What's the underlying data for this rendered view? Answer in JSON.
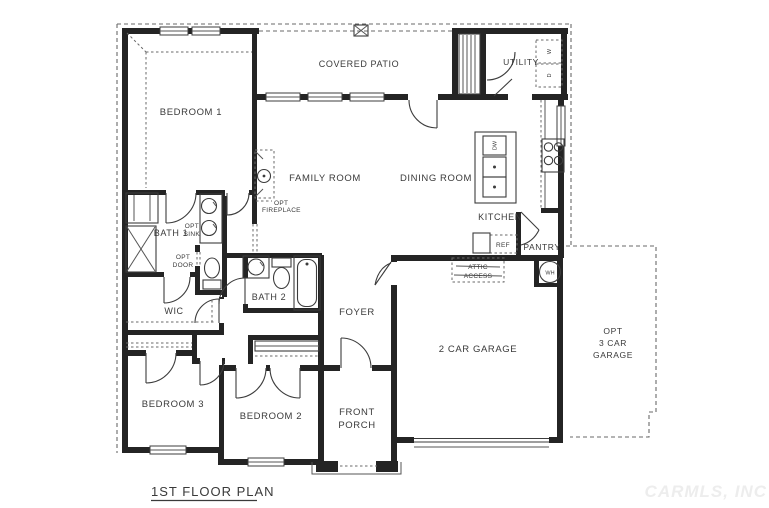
{
  "plan": {
    "title": "1ST FLOOR PLAN",
    "watermark": "CARMLS, INC",
    "rooms": {
      "bedroom1": "BEDROOM 1",
      "bedroom2": "BEDROOM 2",
      "bedroom3": "BEDROOM 3",
      "bath1": "BATH 1",
      "bath2": "BATH 2",
      "wic": "WIC",
      "family_room": "FAMILY ROOM",
      "dining_room": "DINING ROOM",
      "kitchen": "KITCHEN",
      "utility": "UTILITY",
      "covered_patio": "COVERED PATIO",
      "foyer": "FOYER",
      "pantry": "PANTRY",
      "garage": "2 CAR GARAGE",
      "front_porch_line1": "FRONT",
      "front_porch_line2": "PORCH",
      "opt_garage_line1": "OPT",
      "opt_garage_line2": "3 CAR",
      "opt_garage_line3": "GARAGE"
    },
    "options": {
      "opt_fireplace_line1": "OPT",
      "opt_fireplace_line2": "FIREPLACE",
      "opt_sink_line1": "OPT",
      "opt_sink_line2": "SINK",
      "opt_door_line1": "OPT",
      "opt_door_line2": "DOOR",
      "attic_line1": "ATTIC",
      "attic_line2": "ACCESS"
    },
    "appliances": {
      "refrigerator": "REF",
      "dishwasher": "DW",
      "washer": "W",
      "dryer": "D",
      "water_heater": "WH"
    },
    "colors": {
      "wall": "#242424",
      "line": "#3c3c3c",
      "dashed": "#6a6a6a",
      "text": "#3a3a3a",
      "watermark": "#ededed",
      "background": "#ffffff"
    }
  }
}
